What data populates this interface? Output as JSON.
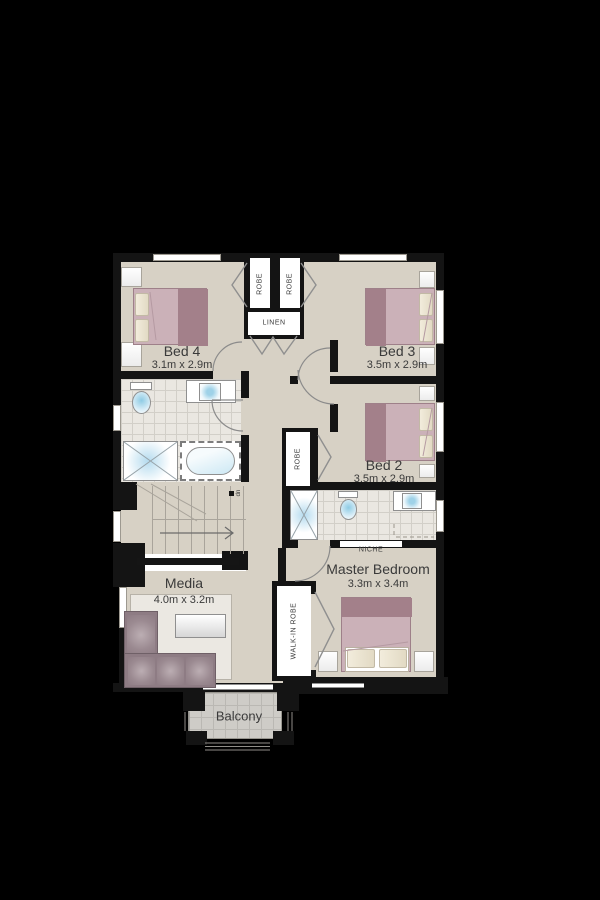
{
  "colors": {
    "background": "#000000",
    "wall": "#141414",
    "floor": "#d7d1c5",
    "tile_floor": "#eae7e1",
    "balcony_floor": "#ceccc7",
    "rug": "#ebe8e2",
    "bed_light": "#cbb1b8",
    "bed_dark": "#a3808a",
    "pillow": "#ece5d3",
    "sofa": "#8e7c84",
    "fixture_blue": "#aed7e9",
    "text": "#3a3a3a"
  },
  "rooms": {
    "bed4": {
      "name": "Bed 4",
      "dims": "3.1m x 2.9m"
    },
    "bed3": {
      "name": "Bed 3",
      "dims": "3.5m x 2.9m"
    },
    "bed2": {
      "name": "Bed 2",
      "dims": "3.5m x 2.9m"
    },
    "master": {
      "name": "Master Bedroom",
      "dims": "3.3m x 3.4m"
    },
    "media": {
      "name": "Media",
      "dims": "4.0m x 3.2m"
    },
    "balcony": {
      "name": "Balcony"
    }
  },
  "closets": {
    "robe_left": "ROBE",
    "robe_right": "ROBE",
    "linen": "LINEN",
    "robe_bed2": "ROBE",
    "walk_in_robe": "WALK-IN ROBE",
    "niche": "NICHE"
  },
  "stairs": {
    "down_marker": "dn"
  }
}
